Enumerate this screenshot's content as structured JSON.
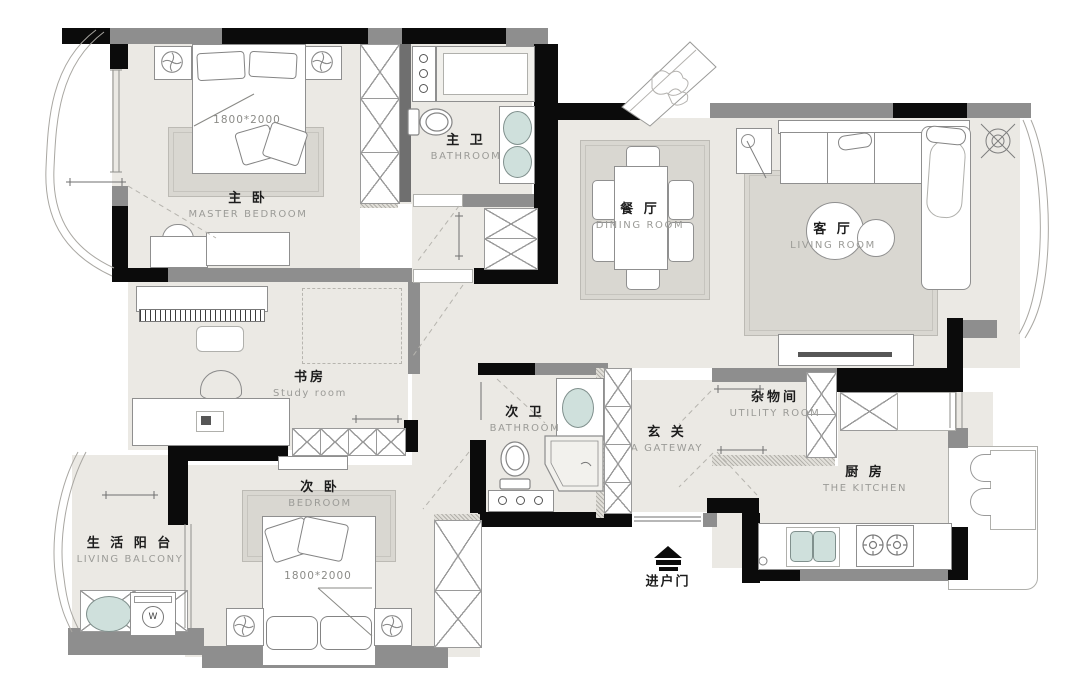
{
  "rooms": {
    "master_bedroom": {
      "zh": "主 卧",
      "en": "MASTER BEDROOM"
    },
    "master_bath": {
      "zh": "主 卫",
      "en": "BATHROOM"
    },
    "dining": {
      "zh": "餐 厅",
      "en": "DINING ROOM"
    },
    "living": {
      "zh": "客 厅",
      "en": "LIVING ROOM"
    },
    "study": {
      "zh": "书房",
      "en": "Study room"
    },
    "second_bath": {
      "zh": "次 卫",
      "en": "BATHROOM"
    },
    "gateway": {
      "zh": "玄 关",
      "en": "A GATEWAY"
    },
    "utility": {
      "zh": "杂物间",
      "en": "UTILITY ROOM"
    },
    "kitchen": {
      "zh": "厨 房",
      "en": "THE KITCHEN"
    },
    "second_bedroom": {
      "zh": "次 卧",
      "en": "BEDROOM"
    },
    "balcony": {
      "zh": "生 活 阳 台",
      "en": "LIVING BALCONY"
    }
  },
  "labels": {
    "master_bed_size": "1800*2000",
    "second_bed_size": "1800*2000",
    "entry_door": "进户门",
    "washer": "W"
  },
  "colors": {
    "wall_black": "#0b0b0b",
    "wall_gray": "#8e8e8e",
    "floor": "#ebe9e4",
    "rug": "#d9d7d1",
    "fixture_teal": "#cfe0dc"
  }
}
